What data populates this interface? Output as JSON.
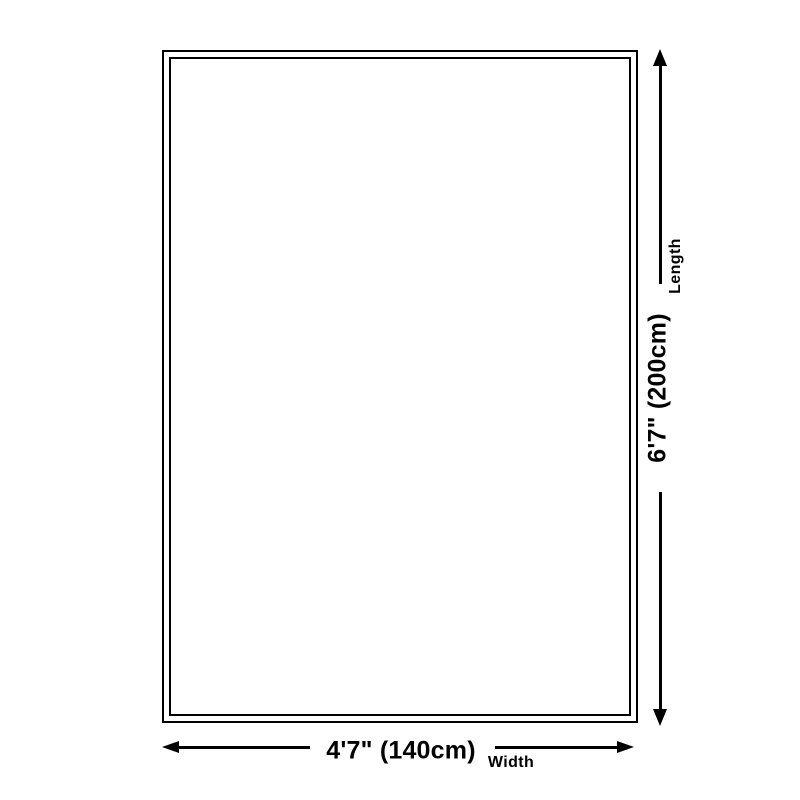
{
  "colors": {
    "line": "#000000",
    "background": "#ffffff"
  },
  "rug": {
    "style": "double-border-rectangle",
    "fill": "#ffffff",
    "border": "#000000"
  },
  "length_dimension": {
    "value": "6'7\" (200cm)",
    "label": "Length",
    "orientation": "vertical",
    "arrow_icons": [
      "arrow-up-icon",
      "arrow-down-icon"
    ]
  },
  "width_dimension": {
    "value": "4'7\" (140cm)",
    "label": "Width",
    "orientation": "horizontal",
    "arrow_icons": [
      "arrow-left-icon",
      "arrow-right-icon"
    ]
  }
}
